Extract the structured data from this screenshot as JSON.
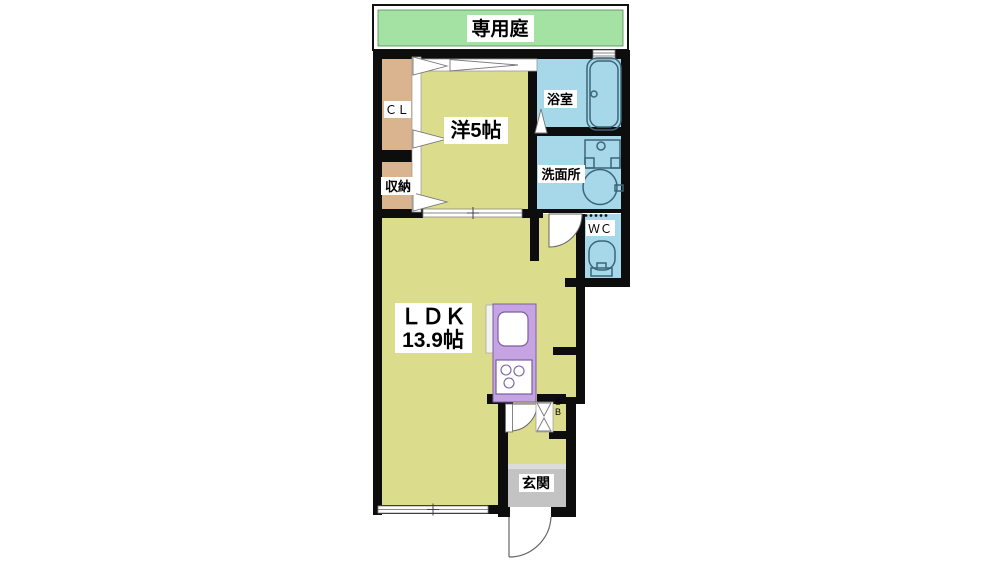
{
  "plan": {
    "type": "apartment-floor-plan",
    "layout_name": "1LDK"
  },
  "rooms": {
    "garden": {
      "label": "専用庭"
    },
    "bedroom": {
      "label": "洋5帖"
    },
    "closet": {
      "label": "ＣＬ"
    },
    "storage": {
      "label": "収納"
    },
    "bath": {
      "label": "浴室"
    },
    "washroom": {
      "label": "洗面所"
    },
    "toilet": {
      "label": "ＷＣ"
    },
    "ldk": {
      "label": "ＬＤＫ",
      "size": "13.9帖"
    },
    "entrance": {
      "label": "玄関"
    },
    "shoebox": {
      "label": "SB"
    }
  },
  "colors": {
    "wall": "#0d0d0d",
    "room_yellow": "#dcdc8d",
    "closet_tan": "#d9b48e",
    "water_blue": "#a7d8e9",
    "garden_green": "#a4e2a4",
    "kitchen_purple": "#c6a3e2",
    "entrance_gray": "#c3c3c3",
    "background": "#ffffff"
  }
}
